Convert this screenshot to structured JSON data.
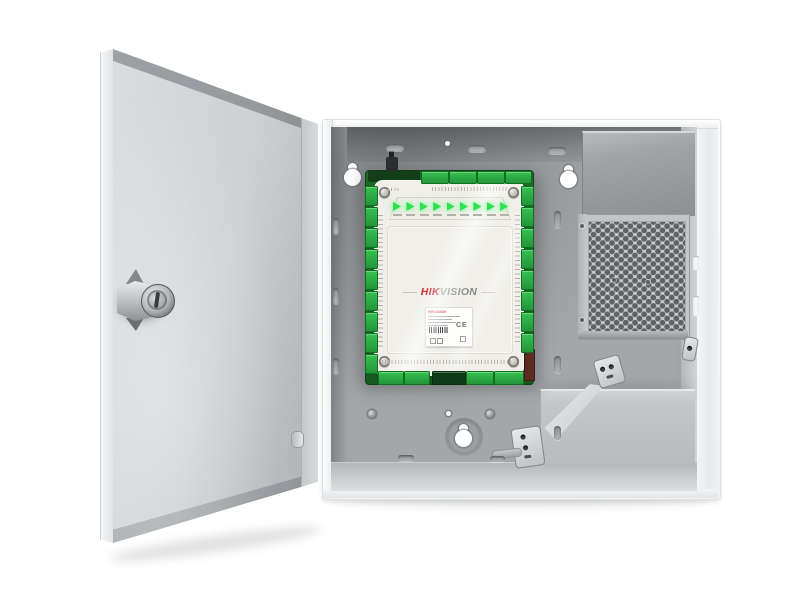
{
  "scene": {
    "type": "product-photo",
    "subject": "Hikvision access controller board mounted inside an open metal wall enclosure with door, power supply and battery tray",
    "background_color": "#ffffff"
  },
  "board": {
    "brand_hik": "HIK",
    "brand_vision": "VISION",
    "led_count": 9,
    "colors": {
      "pcb": "#1a6b27",
      "terminal_block": "#2eb34a",
      "cover": "#f0efe9",
      "led": "#2ee14f",
      "brand_red": "#c4161c",
      "brand_gray": "#85878a"
    }
  },
  "label": {
    "brand": "HIKVISION",
    "ce": "CE"
  },
  "enclosure": {
    "colors": {
      "door_face": "#cdd0d2",
      "interior_wall": "#a4a7aa",
      "frame": "#f1f2f3",
      "mesh_hole": "#5e6265"
    }
  }
}
